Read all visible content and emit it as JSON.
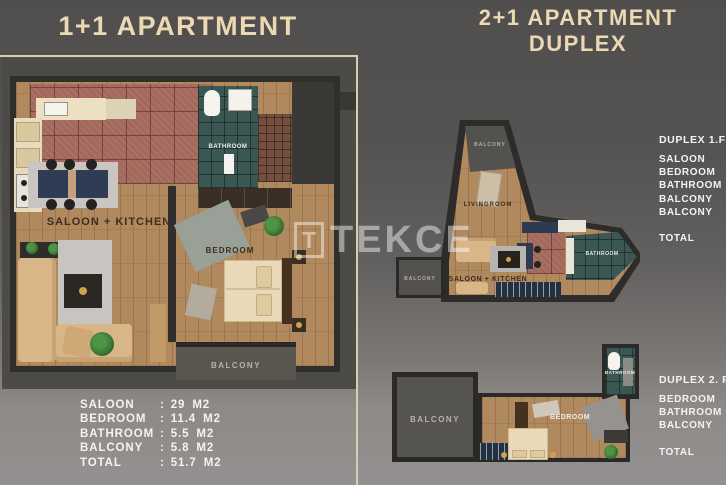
{
  "left": {
    "title": "1+1 APARTMENT",
    "plan_labels": {
      "saloon_kitchen": "SALOON + KITCHEN",
      "bathroom": "BATHROOM",
      "bedroom": "BEDROOM",
      "balcony": "BALCONY"
    },
    "area_table": {
      "separator": ":",
      "rows": [
        {
          "label": "SALOON",
          "value": "29",
          "unit": "M2"
        },
        {
          "label": "BEDROOM",
          "value": "11.4",
          "unit": "M2"
        },
        {
          "label": "BATHROOM",
          "value": "5.5",
          "unit": "M2"
        },
        {
          "label": "BALCONY",
          "value": "5.8",
          "unit": "M2"
        },
        {
          "label": "TOTAL",
          "value": "51.7",
          "unit": "M2"
        }
      ]
    }
  },
  "right": {
    "title_line1": "2+1 APARTMENT",
    "title_line2": "DUPLEX",
    "floor1": {
      "labels": {
        "balcony_top": "BALCONY",
        "livingroom": "LIVINGROOM",
        "saloon_kitchen": "SALOON + KITCHEN",
        "bathroom": "BATHROOM",
        "balcony_left": "BALCONY"
      },
      "table": {
        "header": "DUPLEX 1.FL",
        "rows": [
          "SALOON",
          "BEDROOM",
          "BATHROOM",
          "BALCONY",
          "BALCONY"
        ],
        "total": "TOTAL"
      }
    },
    "floor2": {
      "labels": {
        "balcony": "BALCONY",
        "bedroom": "BEDROOM",
        "bathroom": "BATHROOM"
      },
      "table": {
        "header": "DUPLEX 2. FL",
        "rows": [
          "BEDROOM",
          "BATHROOM",
          "BALCONY"
        ],
        "total": "TOTAL"
      }
    }
  },
  "watermark": {
    "logo_letter": "T",
    "text": "TEKCE"
  },
  "colors": {
    "background_top": "#514f4d",
    "background_bottom": "#939190",
    "title_text": "#ecd9b3",
    "table_text": "#f4f3f1",
    "wall": "#312f2c",
    "wood_floor": "#b1895f",
    "kitchen_tile": "#a3685b",
    "bathroom_tile": "#3a5754",
    "balcony_gray": "#595650",
    "navy_furniture": "#2f3c54",
    "sofa_tan": "#d9b687"
  }
}
